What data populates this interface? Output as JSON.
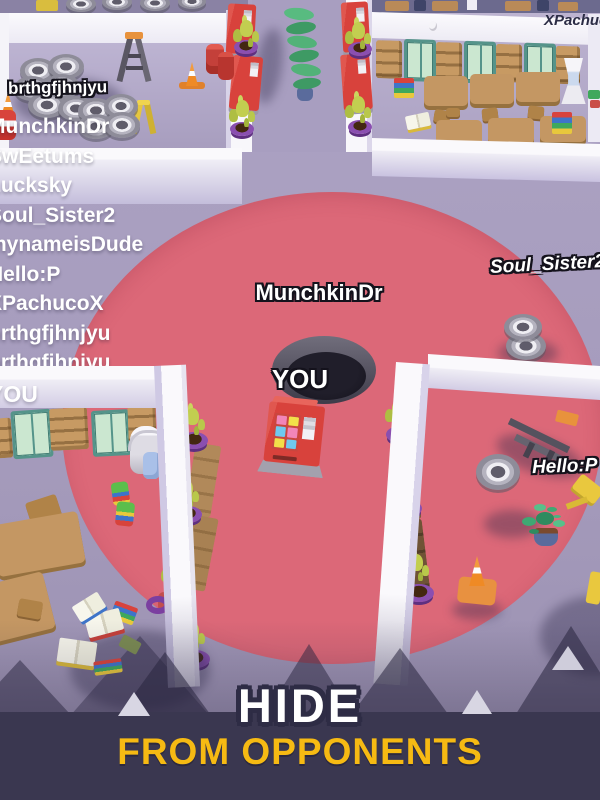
{
  "banner": {
    "title": "HIDE",
    "subtitle": "FROM OPPONENTS",
    "title_color": "#FFFFFF",
    "subtitle_color": "#F6BA13",
    "background": "#3A3750"
  },
  "hole": {
    "label": "YOU",
    "owner": "MunchkinDr"
  },
  "nametags": {
    "topLeft": "brthgfjhnjyu",
    "topRight": "XPachucoX",
    "right": "Soul_Sister2",
    "bottomRight": "Hello:P"
  },
  "playerList": [
    "MunchkinDr",
    "SwEetums",
    "Lucksky",
    "Soul_Sister2",
    "mynameisDude",
    "Hello:P",
    "XPachucoX",
    "brthgfjhnjyu",
    "brthgfjhnjyu",
    "YOU"
  ],
  "colors": {
    "dangerZone": "#DC6878",
    "floor": "#A49ABA"
  }
}
